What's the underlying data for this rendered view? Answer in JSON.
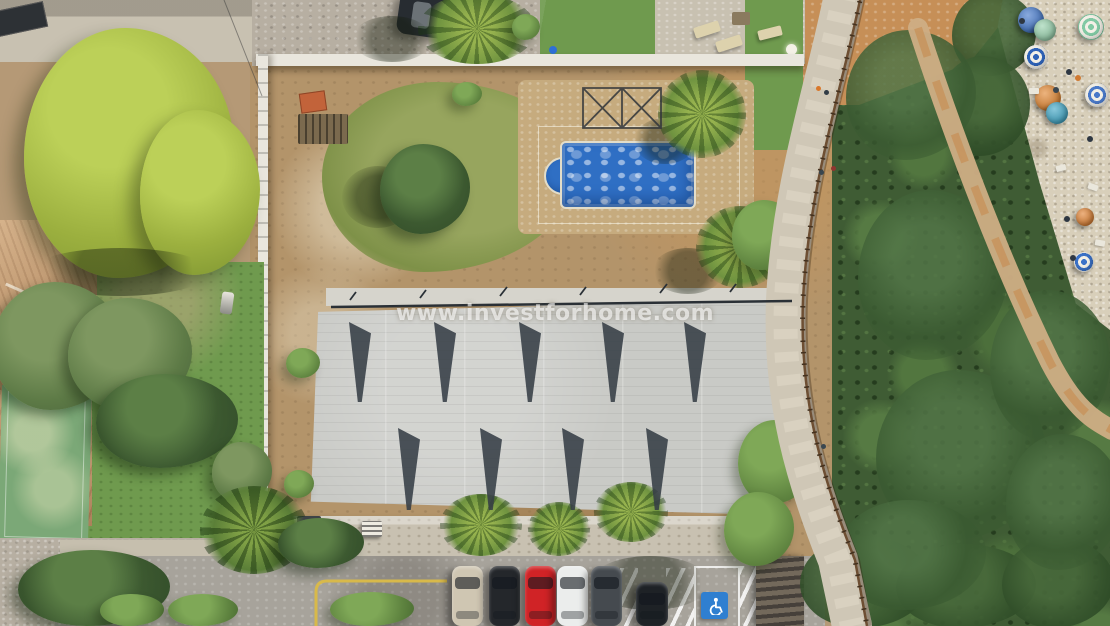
{
  "meta": {
    "type": "aerial-drone-photo",
    "description": "Aerial view of a coastal building plot: new-build concrete roof, swimming pool under construction, neighbouring villa with terracotta roof and sports court, wooden-railed boardwalk, pine woods, beach with umbrellas, and street parking with a disabled bay."
  },
  "watermark": {
    "text": "www.investforhome.com",
    "color": "#ffffff"
  },
  "palette": {
    "plot_dirt": "#b3946a",
    "grass_patch": "#8f9b55",
    "roof_concrete": "#c9cac6",
    "roof_strip": "#d6d4cc",
    "roof_shadow": "#353d45",
    "pool_water": "#2f6fc4",
    "lawn_green": "#6f9a4e",
    "tree_bright": "#a3b949",
    "tree_dark": "#42603a",
    "terracotta_roof": "#c0946a",
    "court_green": "#7ba877",
    "gravel": "#b7afa2",
    "road_asphalt": "#a7a39b",
    "path_stone": "#cfc7b6",
    "path_center": "#ddd6c5",
    "railing_wood": "#6e4f33",
    "railing_posts": "#43311f",
    "beach_sand": "#d8cfba",
    "yellow_line": "#d8b94a",
    "handicap_blue": "#2f7fd0",
    "wall_white": "#e9e6dd",
    "orange_dirt": "#c68f57",
    "sand_trail": "#cfae85",
    "trail_orange": "#c68b4e",
    "concrete_pale": "#c8c1b1",
    "deck_tan": "#c6ab7e",
    "woods_green": "#3f5c34",
    "frame_metal": "#2f343a",
    "car_top": "#272c31",
    "edge_line": "#2a3036",
    "cable": "#3a3a3a"
  },
  "scene": {
    "roof": {
      "wedge_rows": [
        {
          "y": 322,
          "h": 80,
          "x": [
            349,
            434,
            519,
            602,
            684
          ]
        },
        {
          "y": 428,
          "h": 82,
          "x": [
            398,
            480,
            562,
            646
          ]
        }
      ]
    },
    "parking": {
      "cars": [
        {
          "name": "car-beige",
          "color": "#cfc6b2",
          "x": 452
        },
        {
          "name": "car-black",
          "color": "#24272b",
          "x": 489
        },
        {
          "name": "car-red",
          "color": "#d02326",
          "x": 525
        },
        {
          "name": "car-white",
          "color": "#ebedec",
          "x": 557
        },
        {
          "name": "car-grey",
          "color": "#454a4f",
          "x": 591
        },
        {
          "name": "car-black-rear",
          "color": "#1e2226",
          "x": 636,
          "y": 582,
          "h": 44,
          "w": 32
        }
      ],
      "handicap_icon": "wheelchair"
    },
    "beach": {
      "umbrellas": [
        {
          "x": 1031,
          "y": 20,
          "r": 13,
          "color": "#3b72c8",
          "type": "solid"
        },
        {
          "x": 1045,
          "y": 30,
          "r": 11,
          "color": "#93cfa9",
          "type": "solid"
        },
        {
          "x": 1091,
          "y": 27,
          "r": 13,
          "color": "#82c9a4",
          "type": "rings"
        },
        {
          "x": 1036,
          "y": 57,
          "r": 12,
          "color": "#2f63b8",
          "type": "rings"
        },
        {
          "x": 1048,
          "y": 98,
          "r": 13,
          "color": "#e08128",
          "type": "solid"
        },
        {
          "x": 1057,
          "y": 113,
          "r": 11,
          "color": "#38a3c4",
          "type": "solid"
        },
        {
          "x": 1097,
          "y": 95,
          "r": 12,
          "color": "#4a79c8",
          "type": "rings"
        },
        {
          "x": 1085,
          "y": 217,
          "r": 9,
          "color": "#df7d2a",
          "type": "solid"
        },
        {
          "x": 1084,
          "y": 262,
          "r": 10,
          "color": "#3b72c8",
          "type": "rings"
        }
      ],
      "people": [
        {
          "x": 1022,
          "y": 21,
          "c": "#2e3742"
        },
        {
          "x": 1069,
          "y": 72,
          "c": "#2e3742"
        },
        {
          "x": 1078,
          "y": 78,
          "c": "#cf7a33"
        },
        {
          "x": 1090,
          "y": 139,
          "c": "#2e3742"
        },
        {
          "x": 1067,
          "y": 219,
          "c": "#2e3742"
        },
        {
          "x": 1073,
          "y": 258,
          "c": "#2e3742"
        },
        {
          "x": 1056,
          "y": 90,
          "c": "#3a4650"
        }
      ],
      "towels": [
        {
          "x": 1088,
          "y": 184,
          "rot": 20
        },
        {
          "x": 1056,
          "y": 165,
          "rot": -15
        },
        {
          "x": 1095,
          "y": 240,
          "rot": 10
        },
        {
          "x": 1029,
          "y": 88,
          "rot": 0
        }
      ]
    },
    "path_people": [
      {
        "x": 818,
        "y": 88,
        "c": "#d9782b"
      },
      {
        "x": 826,
        "y": 92,
        "c": "#313c46"
      },
      {
        "x": 833,
        "y": 168,
        "c": "#8f3530"
      },
      {
        "x": 821,
        "y": 172,
        "c": "#39464f"
      },
      {
        "x": 823,
        "y": 446,
        "c": "#3a4750"
      }
    ],
    "trees": [
      {
        "x": 24,
        "y": 28,
        "w": 210,
        "h": 250,
        "tone": "bright"
      },
      {
        "x": 140,
        "y": 110,
        "w": 120,
        "h": 165,
        "tone": "bright"
      },
      {
        "x": 30,
        "y": 248,
        "w": 180,
        "h": 48,
        "tone": "shade"
      },
      {
        "x": 352,
        "y": 16,
        "w": 80,
        "h": 46,
        "tone": "shade"
      },
      {
        "x": 418,
        "y": -6,
        "w": 118,
        "h": 70,
        "tone": "palm"
      },
      {
        "x": 512,
        "y": 14,
        "w": 28,
        "h": 26,
        "tone": "mid"
      },
      {
        "x": 634,
        "y": 118,
        "w": 62,
        "h": 46,
        "tone": "shade"
      },
      {
        "x": 658,
        "y": 70,
        "w": 88,
        "h": 88,
        "tone": "palm"
      },
      {
        "x": 652,
        "y": 248,
        "w": 72,
        "h": 46,
        "tone": "shade"
      },
      {
        "x": 696,
        "y": 206,
        "w": 88,
        "h": 82,
        "tone": "palm"
      },
      {
        "x": 342,
        "y": 166,
        "w": 72,
        "h": 62,
        "tone": "shade"
      },
      {
        "x": 380,
        "y": 144,
        "w": 90,
        "h": 90,
        "tone": "dark"
      },
      {
        "x": -8,
        "y": 282,
        "w": 130,
        "h": 128,
        "tone": "olive"
      },
      {
        "x": 68,
        "y": 298,
        "w": 124,
        "h": 112,
        "tone": "olive"
      },
      {
        "x": 96,
        "y": 374,
        "w": 142,
        "h": 94,
        "tone": "dark"
      },
      {
        "x": 212,
        "y": 442,
        "w": 60,
        "h": 60,
        "tone": "olive"
      },
      {
        "x": 200,
        "y": 486,
        "w": 108,
        "h": 88,
        "tone": "palm2"
      },
      {
        "x": 286,
        "y": 348,
        "w": 34,
        "h": 30,
        "tone": "mid"
      },
      {
        "x": 284,
        "y": 470,
        "w": 30,
        "h": 28,
        "tone": "mid"
      },
      {
        "x": 452,
        "y": 82,
        "w": 30,
        "h": 24,
        "tone": "mid"
      },
      {
        "x": 18,
        "y": 550,
        "w": 152,
        "h": 76,
        "tone": "dark"
      },
      {
        "x": 100,
        "y": 594,
        "w": 64,
        "h": 32,
        "tone": "mid"
      },
      {
        "x": 168,
        "y": 594,
        "w": 70,
        "h": 32,
        "tone": "mid"
      },
      {
        "x": 278,
        "y": 518,
        "w": 86,
        "h": 50,
        "tone": "dark"
      },
      {
        "x": 330,
        "y": 592,
        "w": 84,
        "h": 34,
        "tone": "mid"
      },
      {
        "x": 440,
        "y": 494,
        "w": 82,
        "h": 62,
        "tone": "palm"
      },
      {
        "x": 528,
        "y": 502,
        "w": 62,
        "h": 54,
        "tone": "palm"
      },
      {
        "x": 590,
        "y": 556,
        "w": 120,
        "h": 54,
        "tone": "shade"
      },
      {
        "x": 594,
        "y": 482,
        "w": 74,
        "h": 60,
        "tone": "palm"
      },
      {
        "x": 732,
        "y": 200,
        "w": 66,
        "h": 70,
        "tone": "mid"
      },
      {
        "x": 738,
        "y": 420,
        "w": 76,
        "h": 84,
        "tone": "mid"
      },
      {
        "x": 724,
        "y": 492,
        "w": 70,
        "h": 74,
        "tone": "mid"
      },
      {
        "x": 800,
        "y": 536,
        "w": 130,
        "h": 92,
        "tone": "deep"
      },
      {
        "x": 896,
        "y": 544,
        "w": 140,
        "h": 84,
        "tone": "deep"
      },
      {
        "x": 1002,
        "y": 538,
        "w": 112,
        "h": 90,
        "tone": "deep"
      },
      {
        "x": 952,
        "y": -8,
        "w": 84,
        "h": 84,
        "tone": "deep"
      },
      {
        "x": 938,
        "y": 56,
        "w": 92,
        "h": 100,
        "tone": "deep"
      },
      {
        "x": 846,
        "y": 30,
        "w": 130,
        "h": 130,
        "tone": "deep2"
      },
      {
        "x": 858,
        "y": 190,
        "w": 150,
        "h": 170,
        "tone": "deep2"
      },
      {
        "x": 876,
        "y": 370,
        "w": 170,
        "h": 170,
        "tone": "deep2"
      },
      {
        "x": 836,
        "y": 500,
        "w": 150,
        "h": 110,
        "tone": "deep2"
      },
      {
        "x": 990,
        "y": 290,
        "w": 120,
        "h": 150,
        "tone": "deep2"
      },
      {
        "x": 1006,
        "y": 434,
        "w": 116,
        "h": 136,
        "tone": "deep2"
      }
    ]
  }
}
